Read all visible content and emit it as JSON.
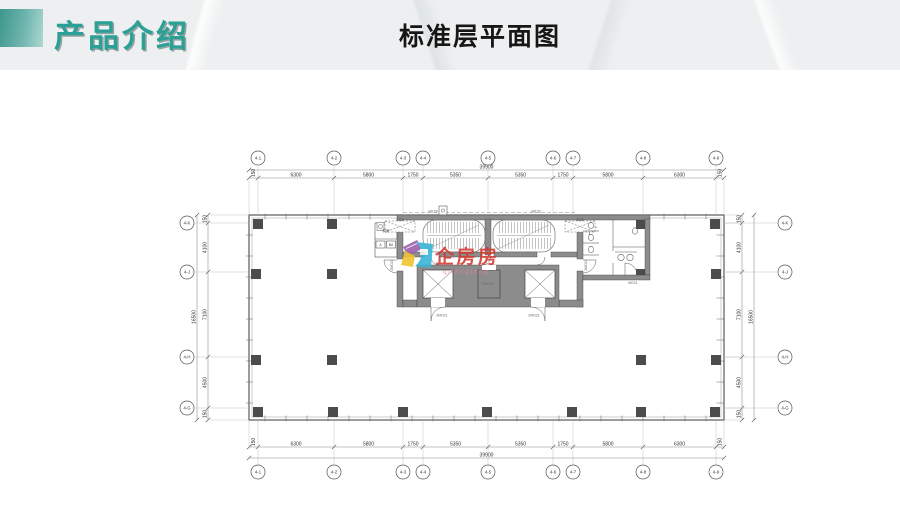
{
  "slide": {
    "section_title": "产品介绍",
    "page_title": "标准层平面图"
  },
  "colors": {
    "accent_teal": "#2AA096",
    "watermark_red": "#D3382F",
    "logo_cyan": "#3AB5D8",
    "logo_yellow": "#F0C431",
    "logo_purple": "#9C5FAE",
    "wall_gray": "#8C8C8C",
    "column_dark": "#4C4C4C"
  },
  "watermark": {
    "text": "企房房",
    "subtext": "qifangfang"
  },
  "floor_plan": {
    "dims": {
      "h_segments": [
        "150",
        "6300",
        "5800",
        "1750",
        "5350",
        "5350",
        "1750",
        "5800",
        "6300",
        "150"
      ],
      "h_total": "39900",
      "v_segments": [
        "150",
        "4100",
        "7100",
        "4500",
        "150"
      ],
      "v_total": "16500",
      "col_labels": [
        "4-1",
        "4-2",
        "4-3",
        "4-4",
        "4-5",
        "4-6",
        "4-7",
        "4-8",
        "4-9"
      ],
      "row_labels": [
        "4-K",
        "4-J",
        "4-H",
        "4-G"
      ]
    },
    "annotations": [
      "BK78",
      "BK78",
      "2M021",
      "2M021",
      "FM022",
      "2M021",
      "2M021",
      "M021"
    ],
    "room_labels": [
      "机房",
      "A",
      "BA"
    ]
  }
}
